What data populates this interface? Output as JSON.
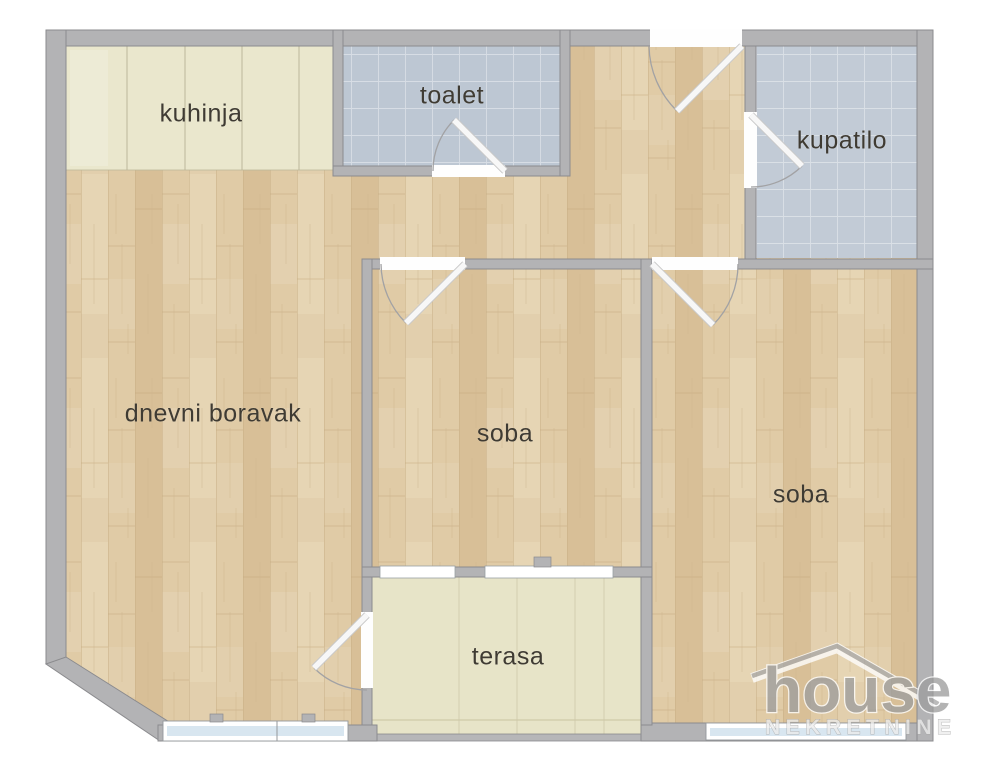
{
  "rooms": {
    "kuhinja": {
      "label": "kuhinja"
    },
    "toalet": {
      "label": "toalet"
    },
    "kupatilo": {
      "label": "kupatilo"
    },
    "dnevni_boravak": {
      "label": "dnevni boravak"
    },
    "soba_1": {
      "label": "soba"
    },
    "soba_2": {
      "label": "soba"
    },
    "terasa": {
      "label": "terasa"
    }
  },
  "watermark": {
    "brand": "house",
    "tagline": "NEKRETNINE"
  },
  "colors": {
    "wall": "#b3b3b5",
    "wall_outline": "#8b8b8e",
    "wood_floor": "#e0cba6",
    "toalet_tile": "#bdc7d3",
    "kupatilo_tile": "#c2cbd6",
    "kitchen_beige": "#eae7cd",
    "terrace_beige": "#e7e4c8",
    "window_glass": "#d8e6f0",
    "door_leaf": "#f7f7f7",
    "label_text": "#3f3b33"
  }
}
